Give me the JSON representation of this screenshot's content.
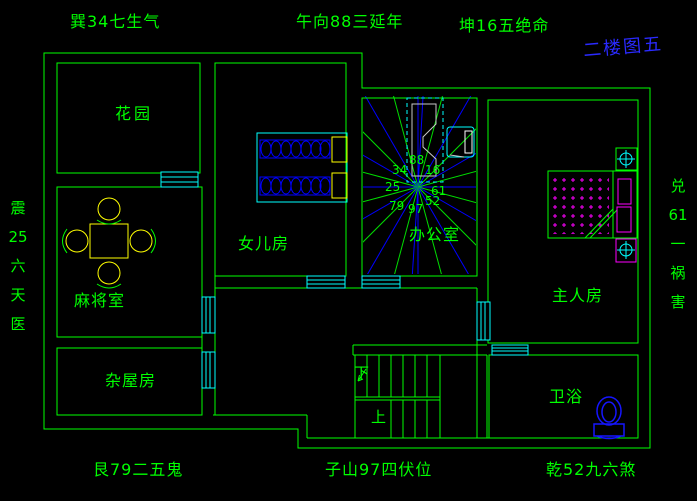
{
  "title": "二楼图五",
  "perimeter_labels": {
    "top_left": "巽34七生气",
    "top_center": "午向88三延年",
    "top_right": "坤16五绝命",
    "left": "震25六天医",
    "right": "兑61一祸害",
    "bottom_left": "艮79二五鬼",
    "bottom_center": "子山97四伏位",
    "bottom_right": "乾52九六煞"
  },
  "rooms": {
    "garden": "花园",
    "daughter": "女儿房",
    "office": "办公室",
    "master": "主人房",
    "mahjong": "麻将室",
    "storage": "杂屋房",
    "bath": "卫浴"
  },
  "stairs": {
    "down": "下",
    "up": "上"
  },
  "star_numbers": {
    "top_left": "34",
    "top": "88",
    "top_right": "16",
    "left": "25",
    "right": "61",
    "bottom_left": "79",
    "bottom_right": "52",
    "bottom": "97"
  },
  "colors": {
    "wall": "#00ff00",
    "window": "#00ffff",
    "ray_blue": "#0000ff",
    "furniture_yellow": "#ffff00",
    "bed_magenta": "#ff00ff",
    "toilet_blue": "#1515ff",
    "stair_gray": "#c8c8c8",
    "title_blue": "#2a2aff",
    "background": "#000000"
  }
}
